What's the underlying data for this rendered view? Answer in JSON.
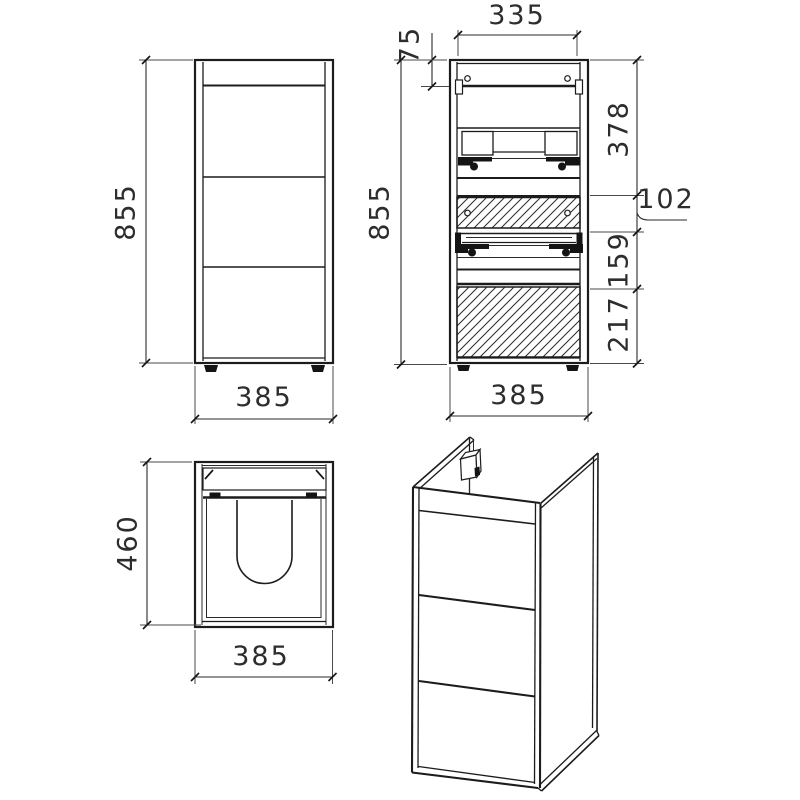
{
  "drawing": {
    "title": "vanity-cabinet-technical-drawing",
    "colors": {
      "line": "#1c1c1c",
      "text": "#2d2d2d",
      "background": "#ffffff"
    },
    "front_view": {
      "height_label": "855",
      "width_label": "385"
    },
    "section_view": {
      "top_width_label": "335",
      "top_offset_label": "75",
      "height_label": "855",
      "segment_top_label": "378",
      "drawer_front_label": "102",
      "segment_mid_label": "159",
      "segment_bottom_label": "217",
      "width_label": "385"
    },
    "plan_view": {
      "depth_label": "460",
      "width_label": "385"
    }
  }
}
